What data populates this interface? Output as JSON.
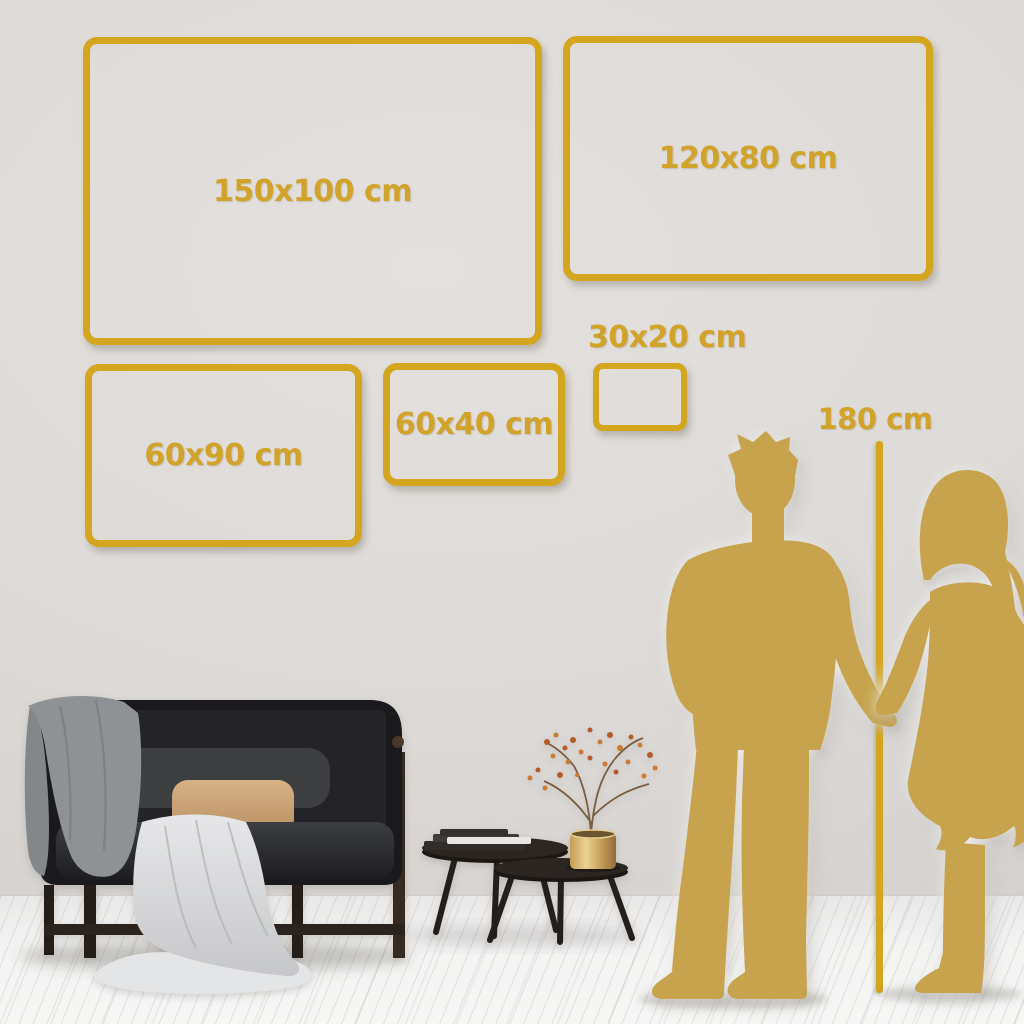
{
  "size_guide": {
    "frames": [
      {
        "id": "150x100",
        "label": "150x100 cm",
        "width_cm": 150,
        "height_cm": 100
      },
      {
        "id": "120x80",
        "label": "120x80 cm",
        "width_cm": 120,
        "height_cm": 80
      },
      {
        "id": "60x90",
        "label": "60x90 cm",
        "width_cm": 60,
        "height_cm": 90
      },
      {
        "id": "60x40",
        "label": "60x40 cm",
        "width_cm": 60,
        "height_cm": 40
      },
      {
        "id": "30x20",
        "label": "30x20 cm",
        "width_cm": 30,
        "height_cm": 20
      }
    ],
    "height_marker": {
      "label": "180 cm",
      "value_cm": 180
    }
  },
  "colors": {
    "frame_gold": "#D4A51E",
    "label_gold": "#D2A32B",
    "silhouette_gold": "#C6A34C",
    "wall": "#DCD9D6",
    "floor": "#F3F3F2"
  },
  "illustration": {
    "objects": [
      "sofa-loveseat",
      "gray-throw-blanket",
      "white-draped-blanket",
      "tan-lumbar-pillow",
      "dark-gray-pillow",
      "nesting-coffee-table-tall",
      "nesting-coffee-table-short",
      "book-stack",
      "brass-vase",
      "dried-branch-with-berries",
      "man-silhouette",
      "woman-silhouette",
      "height-ruler-line"
    ]
  }
}
